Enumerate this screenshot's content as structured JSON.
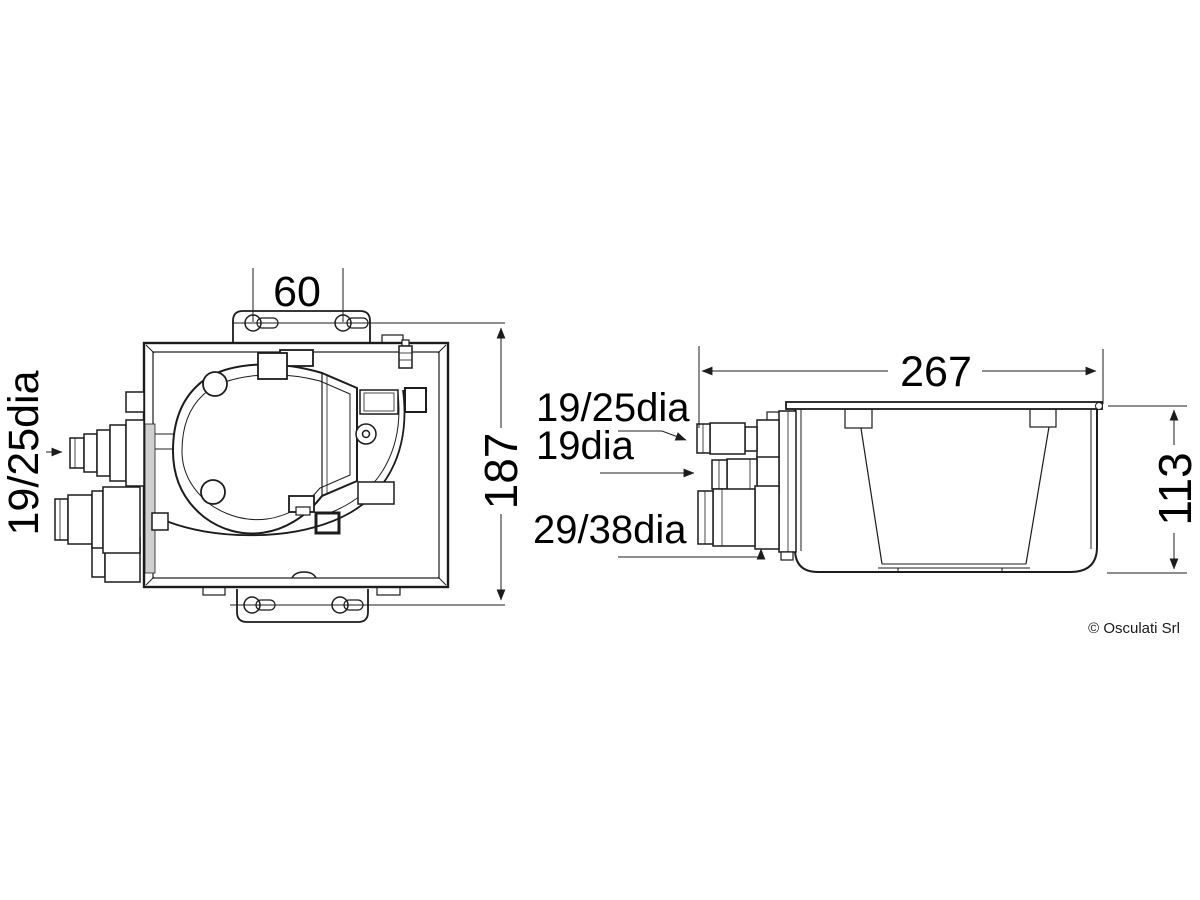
{
  "top_view": {
    "width_label": "60",
    "height_label": "187",
    "port_label": "19/25dia"
  },
  "side_view": {
    "width_label": "267",
    "height_label": "113",
    "port1_label": "19/25dia",
    "port2_label": "19dia",
    "port3_label": "29/38dia"
  },
  "footer": {
    "copyright": "© Osculati Srl"
  },
  "colors": {
    "line": "#1c1c1c",
    "background": "#ffffff"
  }
}
